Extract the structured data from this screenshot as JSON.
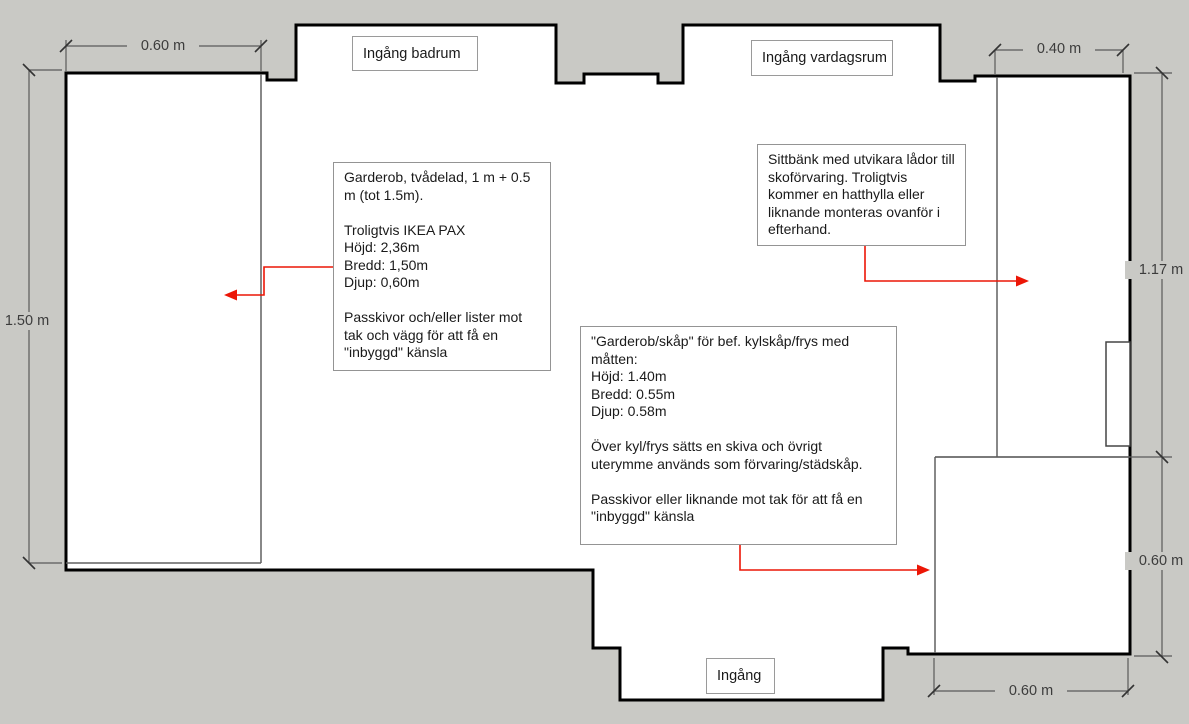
{
  "colors": {
    "background": "#c9c9c5",
    "wall": "#000000",
    "thin_line": "#606060",
    "dimension": "#4f4f4f",
    "arrow_red": "#ec1606"
  },
  "entrances": {
    "badrum": "Ingång badrum",
    "vardagsrum": "Ingång vardagsrum",
    "main": "Ingång"
  },
  "dimensions": {
    "wardrobe_width_top": "0.60 m",
    "wardrobe_length_left": "1.50 m",
    "bench_width_top": "0.40 m",
    "right_wall_upper": "1.17 m",
    "right_wall_lower": "0.60 m",
    "cabinet_width_bottom": "0.60 m"
  },
  "notes": {
    "wardrobe": "Garderob, tvådelad, 1 m + 0.5 m (tot 1.5m).\n\nTroligtvis IKEA PAX\nHöjd: 2,36m\nBredd: 1,50m\nDjup: 0,60m\n\nPasskivor och/eller lister mot tak och vägg för att få en \"inbyggd\" känsla",
    "bench": "Sittbänk med utvikara lådor till skoförvaring. Troligtvis kommer en hatthylla eller liknande monteras ovanför i efterhand.",
    "fridge_cabinet": "\"Garderob/skåp\" för bef. kylskåp/frys med måtten:\nHöjd: 1.40m\nBredd: 0.55m\nDjup: 0.58m\n\nÖver kyl/frys sätts en skiva och övrigt uterymme används som förvaring/städskåp.\n\nPasskivor eller liknande mot tak för att få en \"inbyggd\" känsla"
  }
}
